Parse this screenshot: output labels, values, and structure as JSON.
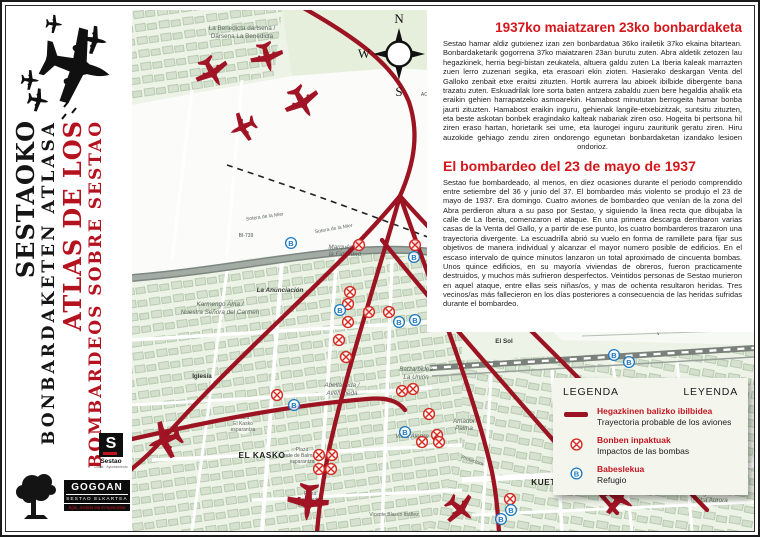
{
  "sidebar": {
    "title_eu_1": "SESTAOKO",
    "title_eu_2": "BONBARDAKETEN ATLASA",
    "title_es_1": "ATLAS DE LOS",
    "title_es_2": "BOMBARDEOS SOBRE SESTAO",
    "logos": {
      "sestao": {
        "letter": "S",
        "name": "Sestao",
        "sub": "Udala · Ayuntamiento"
      },
      "gogoan": {
        "name": "GOGOAN",
        "sub": "SESTAO ELKARTEA",
        "tagline": "Egia, Justizia eta Erreparazioa"
      }
    }
  },
  "panel": {
    "eu": {
      "title": "1937ko maiatzaren 23ko bonbardaketa",
      "body": "Sestao hamar aldiz gutxienez izan zen bonbardatua 36ko irailetik 37ko ekaina bitartean. Bonbardaketarik gogorrena 37ko maiatzaren 23an burutu zuten. Abra aldetik zetozen lau hegazkinek, herria begi-bistan zeukatela, altuera galdu zuten La Iberia kaleak marrazten zuen lerro zuzenari segika, eta erasoari ekin zioten. Hasierako deskargan Venta del Galloko zenbait etxe eraitsi zituzten. Hortik aurrera lau abioek ibilbide dibergente bana trazatu zuten. Eskuadrilak lore sorta baten antzera zabaldu zuen bere hegaldia ahalik eta eraikin gehien harrapatzeko asmoarekin. Hamabost minututan berrogeita hamar bonba jaurti zituzten. Hamabost eraikin inguru, gehienak langile-etxebizitzak, suntsitu zituzten, eta beste askotan bonbek eragindako kalteak nabariak ziren oso. Hogeita bi pertsona hil ziren eraso hartan, horietarik sei ume, eta laurogei inguru zauriturik geratu ziren. Hiru auzokide gehiago zendu ziren ondorengo egunetan bonbardaketan izandako lesioen ondorioz."
    },
    "es": {
      "title": "El bombardeo del 23 de mayo de 1937",
      "body": "Sestao fue bombardeado, al menos, en diez ocasiones durante el periodo comprendido entre setiembre del 36 y junio del 37. El bombardeo más violento se produjo el 23 de mayo de 1937. Era domingo. Cuatro aviones de bombardeo que venían de la zona del Abra perdieron altura a su paso por Sestao, y siguiendo la linea recta que dibujaba la calle de La Iberia, comenzaron el ataque. En una primera descarga derribaron varias casas de la Venta del Gallo, y a partir de ese punto, los cuatro bombarderos trazaron una trayectoria divergente. La escuadrilla abrió su vuelo en forma de ramillete para fijar sus objetivos de manera individual y alcanzar el mayor numero posible de edificios. En el escaso intervalo de quince minutos lanzaron un total aproximado de cincuenta bombas. Unos quince edificios, en su mayoría viviendas de obreros, fueron practicamente destruidos, y muchos más sufrieron desperfectos. Veintidos personas de Sestao murieron en aquel ataque, entre ellas seis niñas/os, y mas de ochenta resultaron heridas. Tres vecinos/as más fallecieron en los días posteriores a consecuencia de las heridas sufridas durante el bombardeo."
    }
  },
  "legend": {
    "header_left": "LEGENDA",
    "header_right": "LEYENDA",
    "items": [
      {
        "icon": "trajectory-line-icon",
        "eu": "Hegazkinen balizko ibilbidea",
        "es": "Trayectoria probable de los aviones"
      },
      {
        "icon": "bomb-impact-icon",
        "eu": "Bonben inpaktuak",
        "es": "Impactos de las bombas"
      },
      {
        "icon": "refuge-icon",
        "eu": "Babeslekua",
        "es": "Refugio"
      }
    ]
  },
  "map": {
    "refuge_letter": "B",
    "compass": {
      "n": "N",
      "s": "S",
      "e": "E",
      "w": "W"
    },
    "colors": {
      "trajectory": "#9c1322",
      "impact": "#d42a22",
      "refuge": "#1d78c0",
      "ground": "#eef3e8"
    },
    "labels": [
      {
        "t": "La Benedicta dartsena /",
        "x": 110,
        "y": 20
      },
      {
        "t": "Dársena La Benedicta",
        "x": 110,
        "y": 28
      },
      {
        "t": "ACB",
        "x": 294,
        "y": 86,
        "c": "road"
      },
      {
        "t": "Sotera de la Mier",
        "x": 133,
        "y": 208,
        "c": "tiny",
        "r": -8
      },
      {
        "t": "Sotera de la Mier",
        "x": 202,
        "y": 220,
        "c": "tiny",
        "r": -10
      },
      {
        "t": "BI-739",
        "x": 114,
        "y": 227,
        "c": "road"
      },
      {
        "t": "Marqués de",
        "x": 213,
        "y": 239,
        "c": "it"
      },
      {
        "t": "la Fidelidad",
        "x": 213,
        "y": 246,
        "c": "it"
      },
      {
        "t": "La Anunciación",
        "x": 148,
        "y": 282,
        "c": "it dk"
      },
      {
        "t": "Karmengo Ama /",
        "x": 88,
        "y": 296,
        "c": "it"
      },
      {
        "t": "Nuestra Señora del Carmen",
        "x": 88,
        "y": 304,
        "c": "it"
      },
      {
        "t": "Iglesia",
        "x": 70,
        "y": 368,
        "c": "dk"
      },
      {
        "t": "EL KASKO",
        "x": 130,
        "y": 448,
        "c": "district"
      },
      {
        "t": "Plaza",
        "x": 111,
        "y": 409,
        "c": "tiny"
      },
      {
        "t": "El Kasko",
        "x": 111,
        "y": 415,
        "c": "tiny"
      },
      {
        "t": "esparantza",
        "x": 111,
        "y": 421,
        "c": "tiny"
      },
      {
        "t": "Plaza",
        "x": 170,
        "y": 441,
        "c": "tiny"
      },
      {
        "t": "Conde de Balmaseda",
        "x": 170,
        "y": 447,
        "c": "tiny"
      },
      {
        "t": "esparantza",
        "x": 170,
        "y": 453,
        "c": "tiny"
      },
      {
        "t": "Plaza",
        "x": 178,
        "y": 485,
        "c": "tiny"
      },
      {
        "t": "San Pedro",
        "x": 178,
        "y": 491,
        "c": "tiny"
      },
      {
        "t": "esparantza",
        "x": 178,
        "y": 497,
        "c": "tiny"
      },
      {
        "t": "Abellaneda /",
        "x": 210,
        "y": 377,
        "c": "it"
      },
      {
        "t": "Avellaneda",
        "x": 210,
        "y": 385,
        "c": "it"
      },
      {
        "t": "Batzarbidea",
        "x": 284,
        "y": 361,
        "c": "it"
      },
      {
        "t": "La Unión",
        "x": 284,
        "y": 369,
        "c": "it"
      },
      {
        "t": "Vista Alegre",
        "x": 280,
        "y": 428,
        "c": "it"
      },
      {
        "t": "Amador",
        "x": 332,
        "y": 413,
        "c": "it"
      },
      {
        "t": "Palma",
        "x": 332,
        "y": 420,
        "c": "it"
      },
      {
        "t": "Protectora",
        "x": 340,
        "y": 452,
        "c": "tiny",
        "r": 18
      },
      {
        "t": "KUETO",
        "x": 415,
        "y": 475,
        "c": "district"
      },
      {
        "t": "El Sol",
        "x": 372,
        "y": 333,
        "c": "dk"
      },
      {
        "t": "Egurtzeta /",
        "x": 582,
        "y": 485,
        "c": "it"
      },
      {
        "t": "La Aurora",
        "x": 582,
        "y": 492,
        "c": "it"
      },
      {
        "t": "Gran Vía de José Antonio Aguirre",
        "x": 462,
        "y": 470,
        "c": "tiny",
        "r": -3
      },
      {
        "t": "Vicente Blasco Ibáñez",
        "x": 262,
        "y": 506,
        "c": "tiny"
      }
    ],
    "impacts": [
      [
        227,
        235
      ],
      [
        283,
        235
      ],
      [
        218,
        282
      ],
      [
        216,
        294
      ],
      [
        237,
        302
      ],
      [
        257,
        302
      ],
      [
        216,
        312
      ],
      [
        207,
        330
      ],
      [
        214,
        347
      ],
      [
        145,
        385
      ],
      [
        270,
        381
      ],
      [
        281,
        379
      ],
      [
        297,
        404
      ],
      [
        187,
        445
      ],
      [
        200,
        445
      ],
      [
        199,
        459
      ],
      [
        187,
        459
      ],
      [
        305,
        425
      ],
      [
        290,
        432
      ],
      [
        307,
        432
      ],
      [
        378,
        489
      ]
    ],
    "refuges": [
      [
        282,
        247
      ],
      [
        159,
        233
      ],
      [
        208,
        300
      ],
      [
        267,
        312
      ],
      [
        283,
        310
      ],
      [
        162,
        395
      ],
      [
        273,
        422
      ],
      [
        379,
        500
      ],
      [
        369,
        509
      ],
      [
        482,
        345
      ],
      [
        497,
        352
      ]
    ],
    "planes": [
      {
        "x": 80,
        "y": 62,
        "r": 150,
        "s": 1.05
      },
      {
        "x": 135,
        "y": 47,
        "r": 165,
        "s": 1.0
      },
      {
        "x": 170,
        "y": 92,
        "r": 150,
        "s": 1.1
      },
      {
        "x": 111,
        "y": 117,
        "r": 245,
        "s": 0.9
      },
      {
        "x": 33,
        "y": 430,
        "r": 250,
        "s": 1.15
      },
      {
        "x": 176,
        "y": 492,
        "r": 185,
        "s": 1.25
      },
      {
        "x": 328,
        "y": 499,
        "r": 130,
        "s": 1.0
      },
      {
        "x": 486,
        "y": 488,
        "r": 120,
        "s": 1.1
      }
    ]
  }
}
